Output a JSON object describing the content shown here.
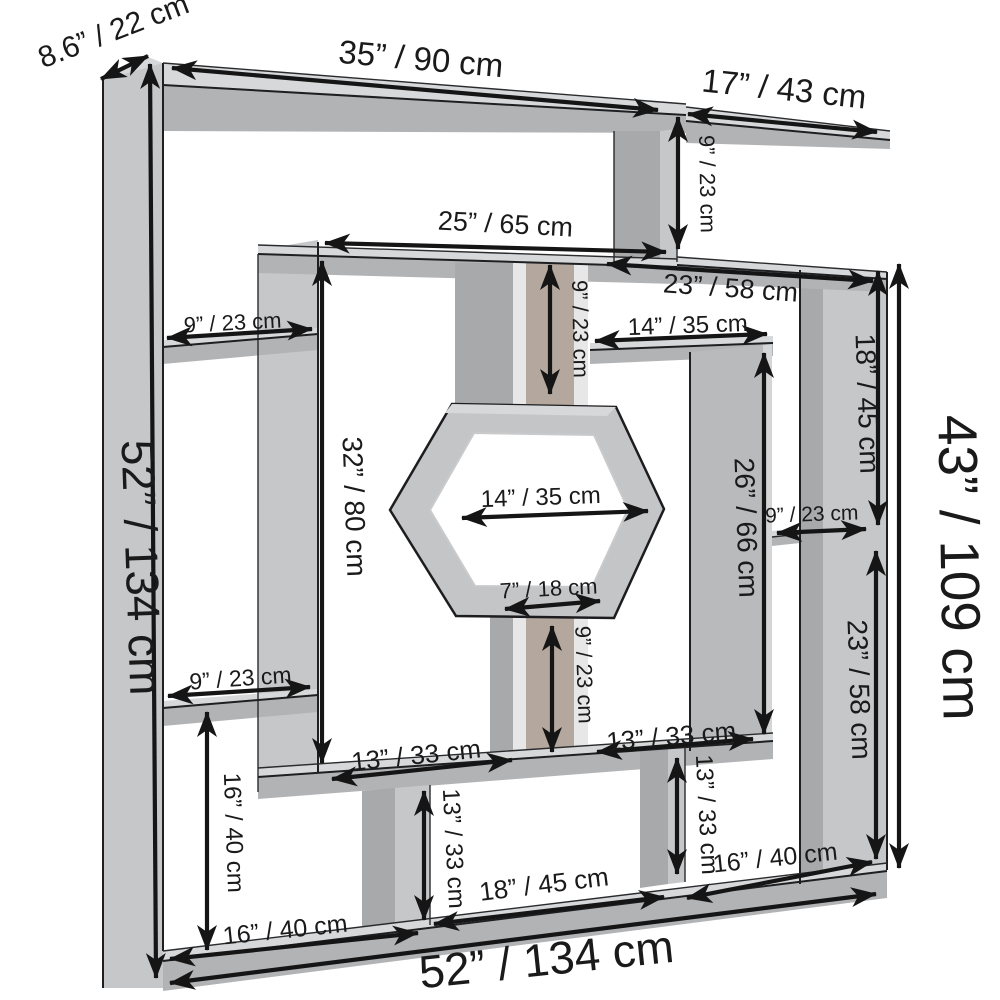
{
  "diagram": {
    "kind": "furniture-dimension-diagram",
    "subject": "geometric maze bookshelf with hexagon center"
  },
  "colors": {
    "background": "#ffffff",
    "face_front": "#c6c7c9",
    "face_side": "#a8a9ab",
    "face_top": "#d7d8d9",
    "shelf_front": "#b2b3b5",
    "inner_shadow": "#b3a79e",
    "light_strip": "#e7e7e8",
    "panel_mid": "#b9babc",
    "panel_light": "#d4d5d6",
    "hex_face": "#c4c5c7",
    "hole_white": "#ffffff",
    "ink": "#1a1a1a"
  },
  "dimensions": [
    {
      "name": "side-depth",
      "text": "8.6” / 22 cm"
    },
    {
      "name": "top-shelf-width",
      "text": "35” / 90 cm"
    },
    {
      "name": "top-right-shelf-width",
      "text": "17” / 43 cm"
    },
    {
      "name": "top-right-drop-height",
      "text": "9” / 23 cm"
    },
    {
      "name": "inner-top-shelf-width",
      "text": "25” / 65 cm"
    },
    {
      "name": "upper-right-shelf-width",
      "text": "23” / 58 cm"
    },
    {
      "name": "left-upper-cubby-width",
      "text": "9” / 23 cm"
    },
    {
      "name": "right-cubby-width",
      "text": "14” / 35 cm"
    },
    {
      "name": "right-upper-height",
      "text": "18” / 45 cm"
    },
    {
      "name": "inner-left-height",
      "text": "32” / 80 cm"
    },
    {
      "name": "center-divider-upper-height",
      "text": "9” / 23 cm"
    },
    {
      "name": "inner-right-height",
      "text": "26” / 66 cm"
    },
    {
      "name": "hexagon-width",
      "text": "14” / 35 cm"
    },
    {
      "name": "right-small-cubby-width",
      "text": "9” / 23 cm"
    },
    {
      "name": "overall-right-height",
      "text": "43” / 109 cm"
    },
    {
      "name": "hexagon-bottom-width",
      "text": "7” / 18 cm"
    },
    {
      "name": "center-divider-lower-height",
      "text": "9” / 23 cm"
    },
    {
      "name": "right-lower-height",
      "text": "23” / 58 cm"
    },
    {
      "name": "left-lower-cubby-width",
      "text": "9” / 23 cm"
    },
    {
      "name": "left-lower-height",
      "text": "16” / 40 cm"
    },
    {
      "name": "inner-bottom-left-width",
      "text": "13” / 33 cm"
    },
    {
      "name": "inner-bottom-right-width",
      "text": "13” / 33 cm"
    },
    {
      "name": "bottom-center-divider-height",
      "text": "13” / 33 cm"
    },
    {
      "name": "bottom-right-divider-height",
      "text": "13” / 33 cm"
    },
    {
      "name": "bottom-left-cubby-width",
      "text": "16” / 40 cm"
    },
    {
      "name": "bottom-center-cubby-width",
      "text": "18” / 45 cm"
    },
    {
      "name": "bottom-right-cubby-width",
      "text": "16” / 40 cm"
    },
    {
      "name": "overall-height",
      "text": "52” / 134 cm"
    },
    {
      "name": "overall-width",
      "text": "52” / 134 cm"
    }
  ]
}
